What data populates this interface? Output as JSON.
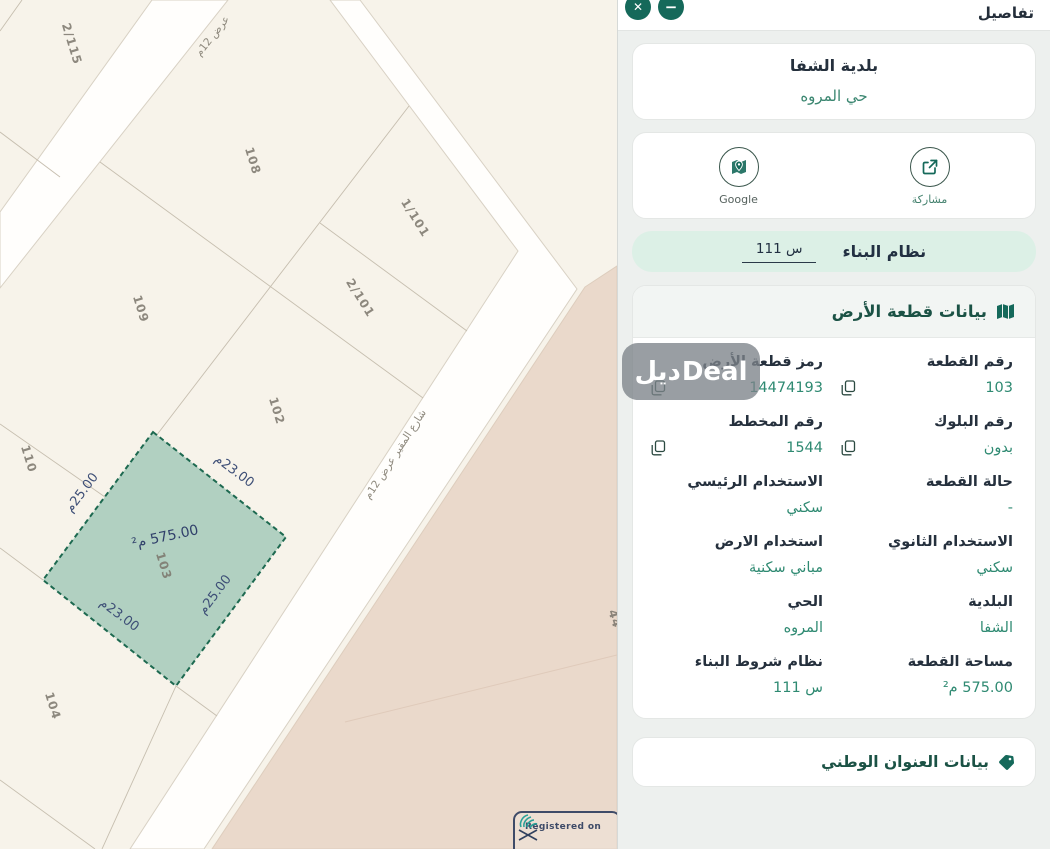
{
  "panel": {
    "header": {
      "title": "تفاصيل",
      "close_glyph": "✕",
      "minimize_glyph": "−"
    },
    "municipality_card": {
      "municipality": "بلدية الشفا",
      "district": "حي المروه"
    },
    "actions": {
      "share_label": "مشاركة",
      "google_label": "Google"
    },
    "building_system": {
      "label": "نظام البناء",
      "value": "س 111"
    },
    "land_card": {
      "title": "بيانات قطعة الأرض",
      "fields": [
        {
          "label": "رقم القطعة",
          "value": "103",
          "copy": true
        },
        {
          "label": "رمز قطعة الأرض",
          "value": "14474193",
          "copy": true
        },
        {
          "label": "رقم البلوك",
          "value": "بدون",
          "copy": true
        },
        {
          "label": "رقم المخطط",
          "value": "1544",
          "copy": true
        },
        {
          "label": "حالة القطعة",
          "value": "-",
          "copy": false
        },
        {
          "label": "الاستخدام الرئيسي",
          "value": "سكني",
          "copy": false
        },
        {
          "label": "الاستخدام الثانوي",
          "value": "سكني",
          "copy": false
        },
        {
          "label": "استخدام الارض",
          "value": "مباني سكنية",
          "copy": false
        },
        {
          "label": "البلدية",
          "value": "الشفا",
          "copy": false
        },
        {
          "label": "الحي",
          "value": "المروه",
          "copy": false
        },
        {
          "label": "مساحة القطعة",
          "value": "575.00 م²",
          "copy": false
        },
        {
          "label": "نظام شروط البناء",
          "value": "س 111",
          "copy": false
        }
      ]
    },
    "national_address_card": {
      "title": "بيانات العنوان الوطني"
    }
  },
  "map": {
    "labels": {
      "p115": "2/115",
      "p108": "108",
      "p1101": "1/101",
      "p2101": "2/101",
      "p109": "109",
      "p102": "102",
      "p110": "110",
      "p104": "104",
      "p44": "44",
      "street1": "عرض 12م",
      "street2": "شارع المقير عرض 12م"
    },
    "selected_parcel": {
      "number": "103",
      "area": "575.00 م²",
      "width_label": "م‎23.00",
      "depth_label": "م‎25.00"
    },
    "badge": {
      "text": "Registered on"
    }
  },
  "watermark": {
    "text_ar": "ديل",
    "text_en": "Deal"
  },
  "colors": {
    "accent_green": "#15695a",
    "value_green": "#2f8a72",
    "selected_parcel_fill": "#9fc7b7",
    "selected_parcel_border": "#1d6950",
    "map_cream": "#f7f3ea",
    "map_pink": "#ead9cb",
    "pill_mint": "#dcf0e6"
  }
}
